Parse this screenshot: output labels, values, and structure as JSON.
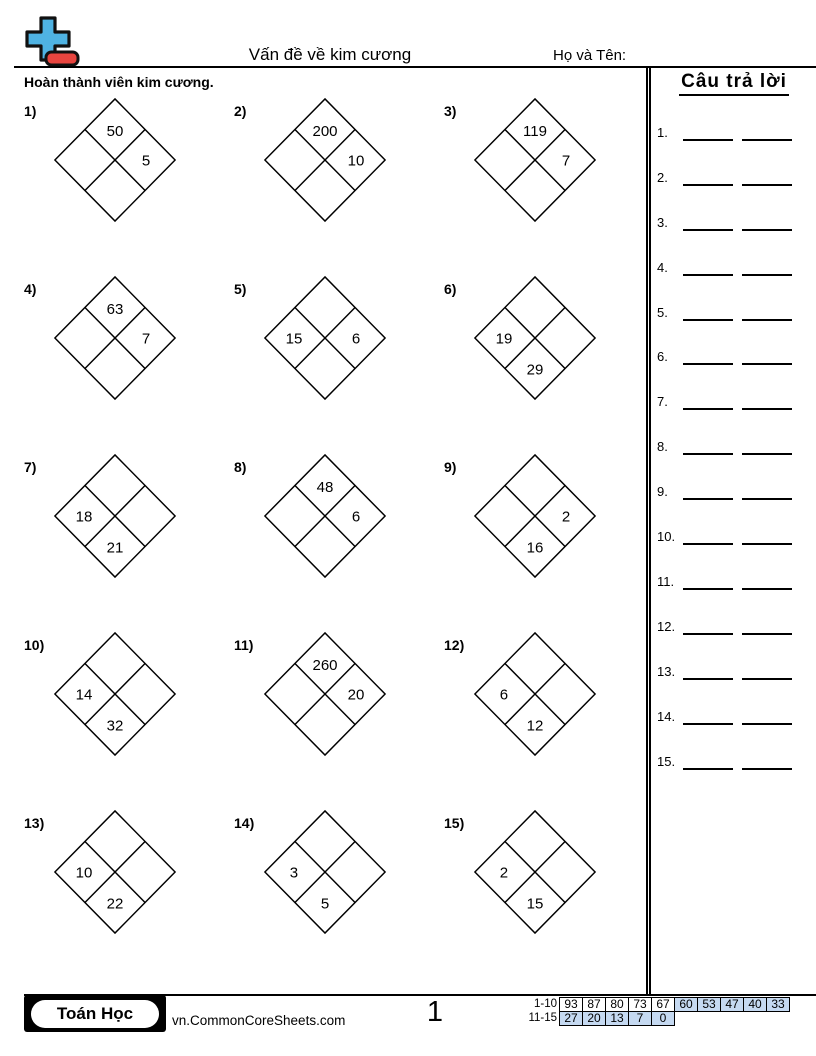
{
  "header": {
    "title": "Vấn đề về kim cương",
    "name_label": "Họ và Tên:",
    "instruction": "Hoàn thành viên kim cương.",
    "logo_colors": {
      "plus": "#4fb3e3",
      "minus": "#e8453f"
    }
  },
  "answers": {
    "title": "Câu trả lời",
    "items": [
      "1.",
      "2.",
      "3.",
      "4.",
      "5.",
      "6.",
      "7.",
      "8.",
      "9.",
      "10.",
      "11.",
      "12.",
      "13.",
      "14.",
      "15."
    ]
  },
  "problems": [
    {
      "label": "1)",
      "top": "50",
      "right": "5",
      "bottom": "",
      "left": ""
    },
    {
      "label": "2)",
      "top": "200",
      "right": "10",
      "bottom": "",
      "left": ""
    },
    {
      "label": "3)",
      "top": "119",
      "right": "7",
      "bottom": "",
      "left": ""
    },
    {
      "label": "4)",
      "top": "63",
      "right": "7",
      "bottom": "",
      "left": ""
    },
    {
      "label": "5)",
      "top": "",
      "right": "6",
      "bottom": "",
      "left": "15"
    },
    {
      "label": "6)",
      "top": "",
      "right": "",
      "bottom": "29",
      "left": "19"
    },
    {
      "label": "7)",
      "top": "",
      "right": "",
      "bottom": "21",
      "left": "18"
    },
    {
      "label": "8)",
      "top": "48",
      "right": "6",
      "bottom": "",
      "left": ""
    },
    {
      "label": "9)",
      "top": "",
      "right": "2",
      "bottom": "16",
      "left": ""
    },
    {
      "label": "10)",
      "top": "",
      "right": "",
      "bottom": "32",
      "left": "14"
    },
    {
      "label": "11)",
      "top": "260",
      "right": "20",
      "bottom": "",
      "left": ""
    },
    {
      "label": "12)",
      "top": "",
      "right": "",
      "bottom": "12",
      "left": "6"
    },
    {
      "label": "13)",
      "top": "",
      "right": "",
      "bottom": "22",
      "left": "10"
    },
    {
      "label": "14)",
      "top": "",
      "right": "",
      "bottom": "5",
      "left": "3"
    },
    {
      "label": "15)",
      "top": "",
      "right": "",
      "bottom": "15",
      "left": "2"
    }
  ],
  "footer": {
    "badge": "Toán Học",
    "site": "vn.CommonCoreSheets.com",
    "page": "1",
    "grade": {
      "row1_label": "1-10",
      "row1": [
        "93",
        "87",
        "80",
        "73",
        "67",
        "60",
        "53",
        "47",
        "40",
        "33"
      ],
      "row2_label": "11-15",
      "row2": [
        "27",
        "20",
        "13",
        "7",
        "0"
      ],
      "highlight_color": "#c5d9f1"
    }
  }
}
